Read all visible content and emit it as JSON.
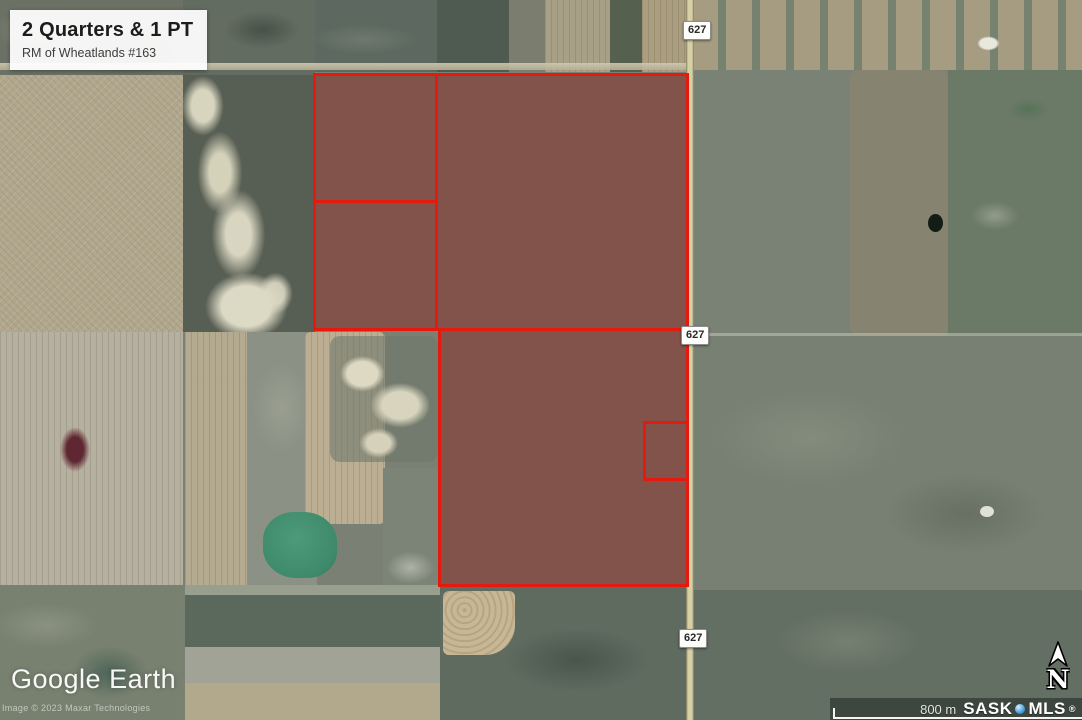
{
  "title_card": {
    "title": "2 Quarters & 1 PT",
    "subtitle": "RM of Wheatlands #163"
  },
  "road": {
    "markers": [
      "627",
      "627",
      "627"
    ]
  },
  "watermark": {
    "logo": "Google Earth",
    "copyright": "Image © 2023 Maxar Technologies"
  },
  "scalebar": {
    "distance": "800 m",
    "brand_sask": "SASK",
    "brand_mls": "MLS",
    "registered": "®"
  },
  "compass": {
    "label": "N"
  },
  "colors": {
    "parcel_border": "#e6190e",
    "parcel_fill": "rgba(138,34,29,0.48)",
    "road_fill": "#d6d1a5",
    "mls_dot": "#3fa0e0"
  }
}
